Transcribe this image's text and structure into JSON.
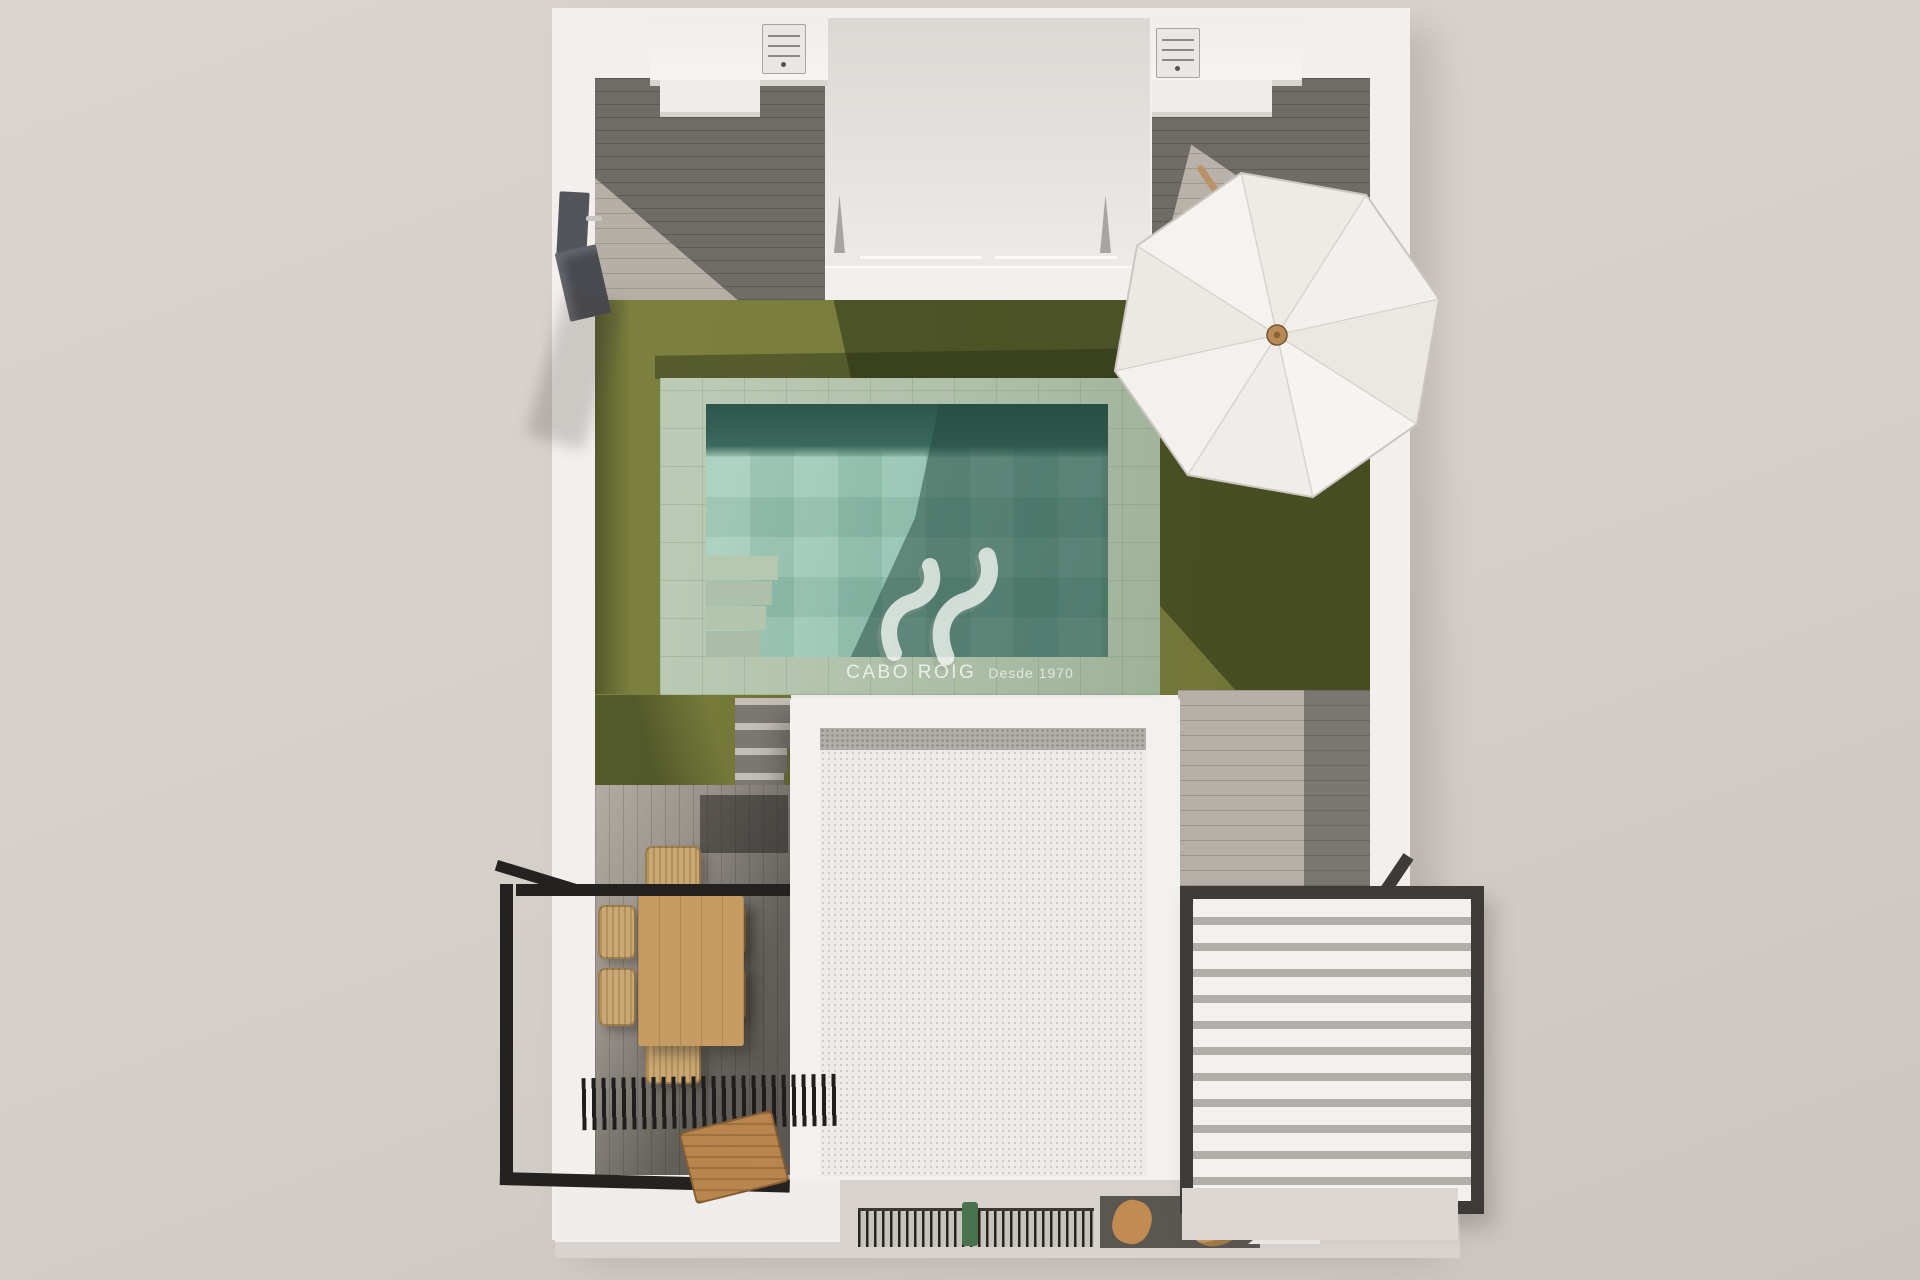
{
  "watermark": {
    "logo": "av-swoosh-logo",
    "brand": "CABO ROIG",
    "tagline": "Desde 1970"
  },
  "palette": {
    "backdrop": "#d6d0cb",
    "wall": "#f2efec",
    "lawn": "#7a7e3e",
    "lawn_shadow": "#3d4722",
    "paving": "#b2c2ac",
    "pool_water": "#97c4b1",
    "pool_deep": "#3b685c",
    "deck_dark": "#6f6b67",
    "deck_light": "#b6b0a9",
    "dining_wood": "#c69c63",
    "wicker": "#c9a873",
    "frame_black": "#242220",
    "louver_frame": "#3e3a37",
    "louver_slat": "#f3f1ee",
    "roof_white": "#f3f1ee",
    "gravel": "#b2afab",
    "umbrella": "#f3f1ee",
    "watermark_white": "#f6f8f5"
  }
}
